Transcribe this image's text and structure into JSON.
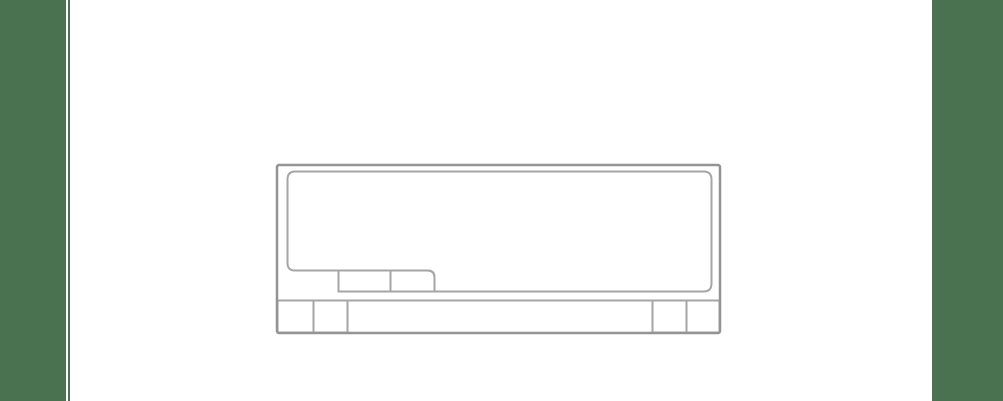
{
  "page": {
    "background_color": "#FFFFFF"
  },
  "side_margins": {
    "left_bar_color": "#4A7150",
    "left_rule_color": "#4A7150",
    "right_bar_color": "#4A7150"
  },
  "diagram": {
    "outer_stroke_color": "#949494",
    "inner_stroke_color": "#A6A6A6",
    "fill_color": "#FFFFFF",
    "subject": "Front elevation line drawing of a rectangular cabinet with a large rounded recessed panel, two small hatches at the panel's lower-left notch, a base rail, and twin feet at each bottom corner",
    "parts": [
      "outer-frame",
      "main-panel",
      "hatch-left",
      "hatch-right",
      "base-rail-line",
      "foot-left-outer",
      "foot-left-inner",
      "foot-right-inner",
      "foot-right-outer"
    ]
  }
}
